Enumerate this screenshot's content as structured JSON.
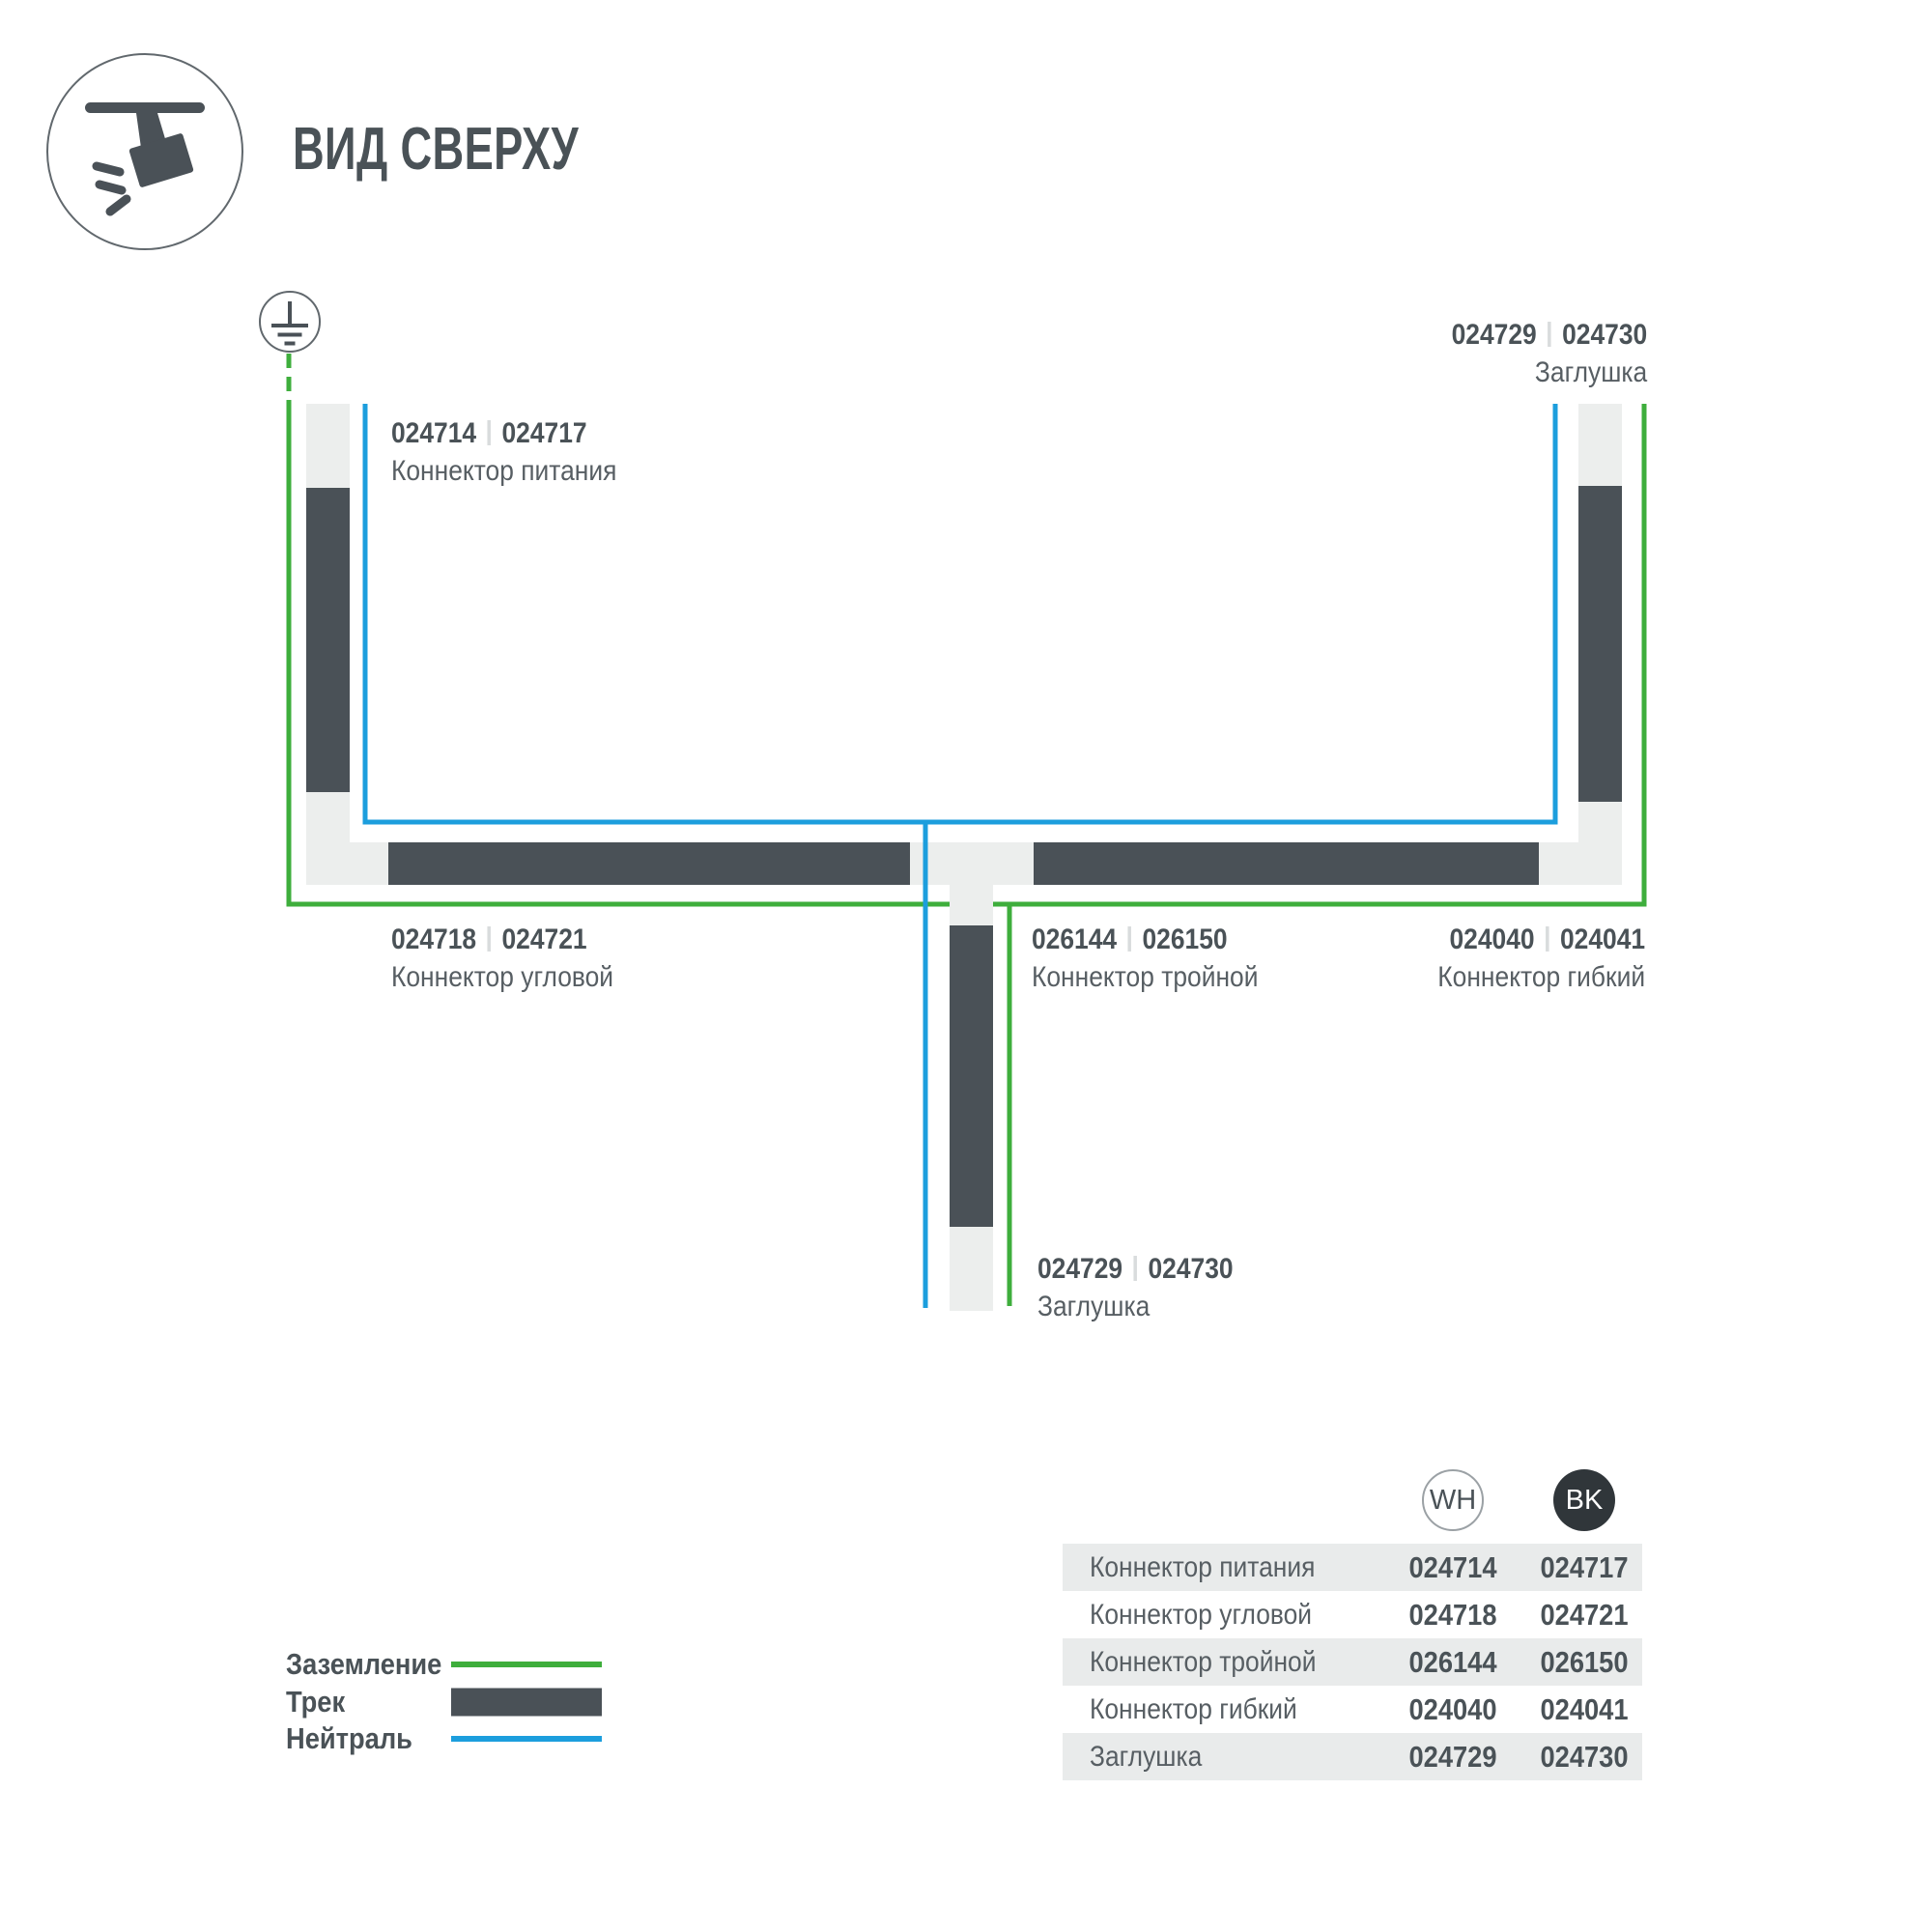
{
  "header": {
    "title": "ВИД СВЕРХУ",
    "icon": "track-spotlight-icon"
  },
  "colors": {
    "ground_green": "#3EAE3C",
    "neutral_blue": "#1C9EDD",
    "track_dark": "#4A5157",
    "track_light": "#ECEEED",
    "row_alt": "#E9EBEB",
    "text_strong": "#4A5257",
    "text_soft": "#575E63",
    "sep_gray": "#D9DCDD",
    "badge_dark": "#30363A",
    "circle_outline": "#61686D"
  },
  "diagram": {
    "ground_symbol": "earth-ground-icon",
    "labels": {
      "power": {
        "code_wh": "024714",
        "code_bk": "024717",
        "name": "Коннектор питания"
      },
      "endcap_top": {
        "code_wh": "024729",
        "code_bk": "024730",
        "name": "Заглушка"
      },
      "corner": {
        "code_wh": "024718",
        "code_bk": "024721",
        "name": "Коннектор угловой"
      },
      "triple": {
        "code_wh": "026144",
        "code_bk": "026150",
        "name": "Коннектор тройной"
      },
      "flexible": {
        "code_wh": "024040",
        "code_bk": "024041",
        "name": "Коннектор гибкий"
      },
      "endcap_bottom": {
        "code_wh": "024729",
        "code_bk": "024730",
        "name": "Заглушка"
      }
    }
  },
  "legend": {
    "items": [
      {
        "label": "Заземление",
        "type": "ground-line"
      },
      {
        "label": "Трек",
        "type": "track-bar"
      },
      {
        "label": "Нейтраль",
        "type": "neutral-line"
      }
    ]
  },
  "table": {
    "columns": [
      {
        "label": "WH"
      },
      {
        "label": "BK"
      }
    ],
    "rows": [
      {
        "name": "Коннектор питания",
        "wh": "024714",
        "bk": "024717"
      },
      {
        "name": "Коннектор угловой",
        "wh": "024718",
        "bk": "024721"
      },
      {
        "name": "Коннектор тройной",
        "wh": "026144",
        "bk": "026150"
      },
      {
        "name": "Коннектор гибкий",
        "wh": "024040",
        "bk": "024041"
      },
      {
        "name": "Заглушка",
        "wh": "024729",
        "bk": "024730"
      }
    ]
  }
}
